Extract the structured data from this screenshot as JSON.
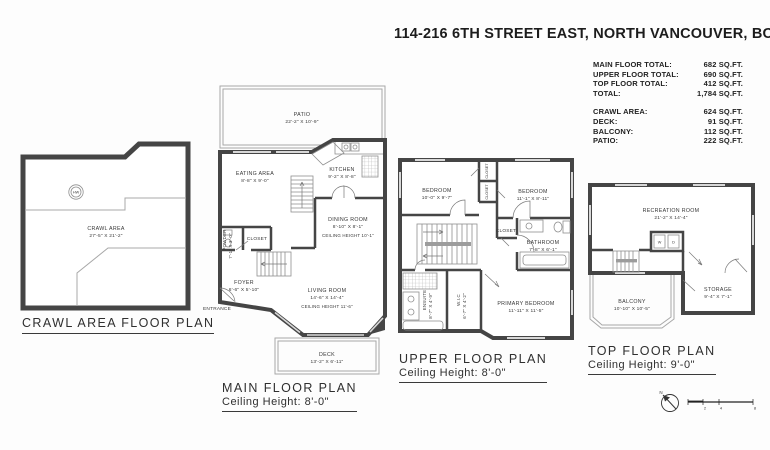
{
  "title": "114-216 6TH STREET EAST, NORTH VANCOUVER, BC",
  "colors": {
    "wall": "#454545",
    "thin_line": "#a8a8a8",
    "label_text": "#383838",
    "title_text": "#1c1c1c"
  },
  "stats": {
    "main_floor": {
      "label": "MAIN FLOOR TOTAL:",
      "value": "682 SQ.FT."
    },
    "upper_floor": {
      "label": "UPPER FLOOR TOTAL:",
      "value": "690 SQ.FT."
    },
    "top_floor": {
      "label": "TOP FLOOR TOTAL:",
      "value": "412 SQ.FT."
    },
    "total": {
      "label": "TOTAL:",
      "value": "1,784 SQ.FT."
    },
    "crawl": {
      "label": "CRAWL AREA:",
      "value": "624 SQ.FT."
    },
    "deck": {
      "label": "DECK:",
      "value": "91 SQ.FT."
    },
    "balcony": {
      "label": "BALCONY:",
      "value": "112 SQ.FT."
    },
    "patio": {
      "label": "PATIO:",
      "value": "222 SQ.FT."
    }
  },
  "plans": {
    "crawl": {
      "title": "CRAWL AREA FLOOR PLAN",
      "room": {
        "name": "CRAWL AREA",
        "dims": "27'-5\" X 21'-2\""
      },
      "hw_label": "HW"
    },
    "main": {
      "title": "MAIN FLOOR PLAN",
      "ceiling": "Ceiling Height: 8'-0\"",
      "patio": {
        "name": "PATIO",
        "dims": "22'-2\" X 10'-9\""
      },
      "eating": {
        "name": "EATING AREA",
        "dims": "8'-8\" X 9'-0\""
      },
      "kitchen": {
        "name": "KITCHEN",
        "dims": "9'-2\" X 8'-8\""
      },
      "dining": {
        "name": "DINING ROOM",
        "dims": "8'-10\" X 8'-1\"",
        "note": "CEILING HEIGHT 10'-1\""
      },
      "closet": "CLOSET",
      "powder": {
        "name": "POWDER",
        "dims": "7'-1\" X 3'-0\""
      },
      "foyer": {
        "name": "FOYER",
        "dims": "6'-6\" X 5'-10\""
      },
      "entrance": "ENTRANCE",
      "living": {
        "name": "LIVING ROOM",
        "dims": "14'-6\" X 14'-4\"",
        "note": "CEILING HEIGHT 11'-6\""
      },
      "deck": {
        "name": "DECK",
        "dims": "13'-2\" X 6'-11\""
      }
    },
    "upper": {
      "title": "UPPER FLOOR PLAN",
      "ceiling": "Ceiling Height: 8'-0\"",
      "bedroom1": {
        "name": "BEDROOM",
        "dims": "10'-0\" X 9'-7\""
      },
      "bedroom2": {
        "name": "BEDROOM",
        "dims": "11'-1\" X 8'-11\""
      },
      "closet1": "CLOSET",
      "closet2": "CLOSET",
      "closet3": "CLOSET",
      "bathroom": {
        "name": "BATHROOM",
        "dims": "7'-8\" X 6'-1\""
      },
      "ensuite": {
        "name": "ENSUITE",
        "dims": "8'-7\" X 4'-9\""
      },
      "wic": {
        "name": "W.I.C",
        "dims": "6'-7\" X 4'-2\""
      },
      "primary": {
        "name": "PRIMARY BEDROOM",
        "dims": "11'-11\" X 11'-5\""
      }
    },
    "top": {
      "title": "TOP FLOOR PLAN",
      "ceiling": "Ceiling Height: 9'-0\"",
      "recreation": {
        "name": "RECREATION ROOM",
        "dims": "21'-2\" X 14'-4\""
      },
      "balcony": {
        "name": "BALCONY",
        "dims": "10'-10\" X 10'-5\""
      },
      "storage": {
        "name": "STORAGE",
        "dims": "9'-4\" X 7'-1\""
      },
      "washer": "W",
      "dryer": "D"
    }
  },
  "compass": {
    "north": "N"
  },
  "scale_bar": {
    "ticks": [
      "2",
      "4",
      "8"
    ]
  }
}
